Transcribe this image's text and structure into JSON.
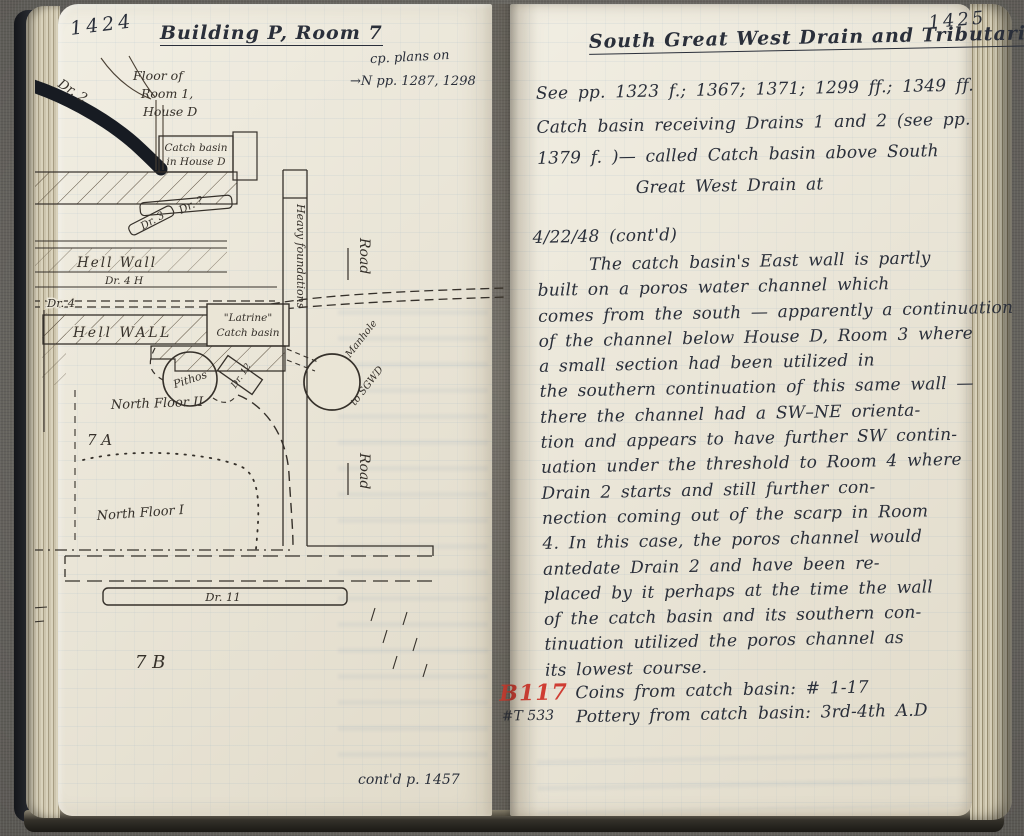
{
  "left_page": {
    "page_number": "1424",
    "title": "Building P, Room 7",
    "cp_note_line1": "cp. plans on",
    "cp_note_line2": "→N   pp. 1287, 1298",
    "contd": "cont'd p. 1457",
    "labels": {
      "dr2": "Dr. 2",
      "floor1": "Floor of",
      "floor2": "Room 1,",
      "floor3": "House D",
      "catch_basin_d_1": "Catch basin",
      "catch_basin_d_2": "in House D",
      "dr_q": "Dr. ?",
      "dr3": "Dr. 3",
      "hell_wall_1": "Hell Wall",
      "dr4h": "Dr. 4 H",
      "dr4": "Dr. 4",
      "hell_wall_2": "Hell WALL",
      "latrine_1": "\"Latrine\"",
      "latrine_2": "Catch basin",
      "heavy_foundations": "Heavy foundations",
      "road_1": "Road",
      "road_2": "Road",
      "pithos": "Pithos",
      "dr12": "Dr. 12",
      "manhole_1": "Manhole",
      "manhole_2": "to SGWD",
      "north_floor_2": "North Floor II",
      "area_7a": "7 A",
      "north_floor_1": "North Floor I",
      "dr11": "Dr. 11",
      "area_7b": "7 B"
    }
  },
  "right_page": {
    "page_number": "1425",
    "title": "South Great West Drain and Tributaries",
    "see_refs": "See pp. 1323 f.; 1367; 1371; 1299 ff.; 1349 ff.",
    "intro_lines": [
      "Catch basin receiving Drains 1 and 2 (see pp.",
      "1379 f. )— called Catch basin above South",
      "Great West Drain at"
    ],
    "date_line": "4/22/48 (cont'd)",
    "body_lines": [
      "The catch basin's East wall is partly",
      "built on a poros water channel which",
      "comes from the south — apparently a continuation",
      "of the channel below House D, Room 3 where",
      "a small section had been utilized in",
      "the southern continuation of this same wall —",
      "there the channel had a SW–NE orienta-",
      "tion and appears to have further SW contin-",
      "uation under the threshold to Room 4 where",
      "Drain 2 starts and still further con-",
      "nection coming out of the scarp in Room",
      "4. In this case, the poros channel would",
      "antedate Drain 2 and have been re-",
      "placed by it perhaps at the time the wall",
      "of the catch basin and its southern con-",
      "tinuation utilized the poros channel as",
      "its lowest course."
    ],
    "find_coins_ref": "B117",
    "find_coins_text": "Coins from catch basin: # 1-17",
    "find_pottery_ref": "#T 533",
    "find_pottery_text": "Pottery from catch basin: 3rd-4th A.D"
  }
}
